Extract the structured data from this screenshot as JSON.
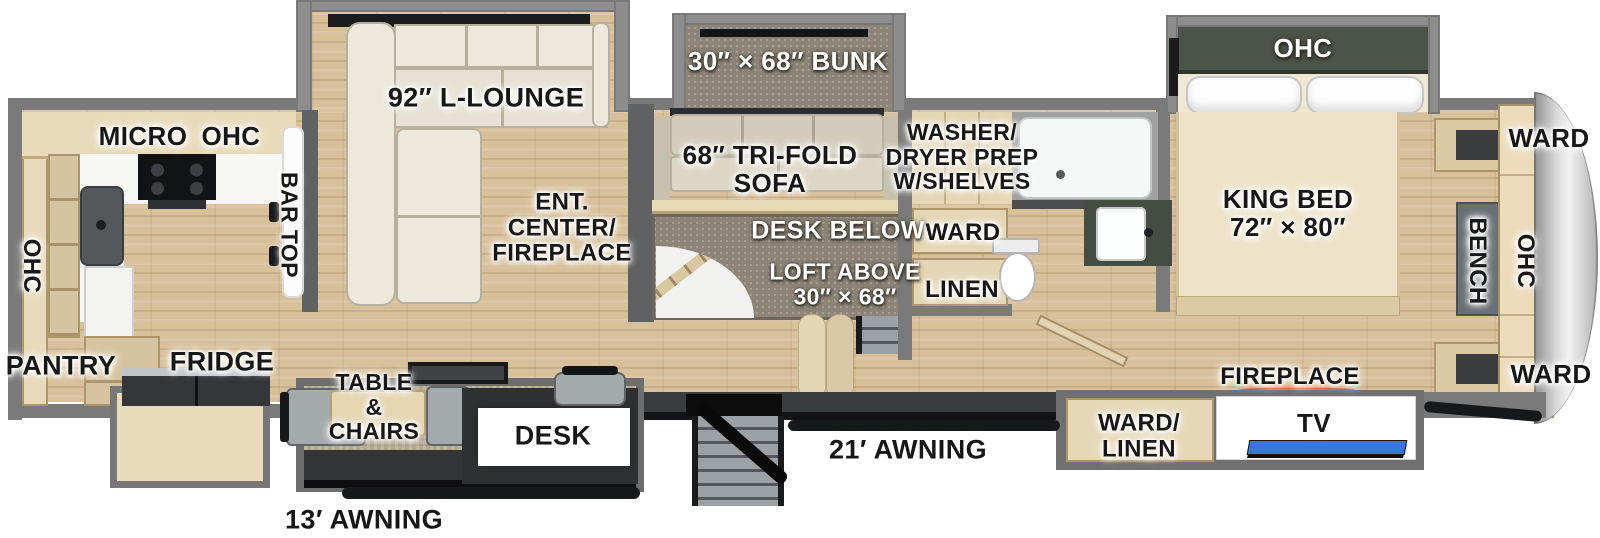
{
  "floorplan": {
    "type": "RV fifth-wheel floor plan",
    "colors": {
      "fireplace_glow": "#ff7a00",
      "tv_screen": "#3d74da",
      "awning_rod": "#17181a",
      "floor_wood": "#d8c09b",
      "wall_gray": "#7a7a7a"
    },
    "labels": {
      "micro": "MICRO",
      "ohc_kitchen_top": "OHC",
      "ohc_kitchen_left": "OHC",
      "pantry": "PANTRY",
      "fridge": "FRIDGE",
      "bar_top": "BAR TOP",
      "lounge": "92″ L-LOUNGE",
      "ent_center": "ENT.\nCENTER/\nFIREPLACE",
      "bunk": "30″ × 68″ BUNK",
      "trifold_sofa": "68″ TRI-FOLD\nSOFA",
      "washer_dryer": "WASHER/\nDRYER PREP\nW/SHELVES",
      "desk_below": "DESK BELOW",
      "loft_above": "LOFT ABOVE\n30″ × 68″",
      "ward_hall": "WARD",
      "linen_hall": "LINEN",
      "king_bed": "KING BED\n72″ × 80″",
      "ohc_bedroom": "OHC",
      "fireplace": "FIREPLACE",
      "ward_linen": "WARD/\nLINEN",
      "tv": "TV",
      "ward_front_top": "WARD",
      "ohc_front": "OHC",
      "bench": "BENCH",
      "ward_front_bottom": "WARD",
      "desk": "DESK",
      "table_chairs": "TABLE\n&\nCHAIRS",
      "awning_13": "13′ AWNING",
      "awning_21": "21′ AWNING"
    }
  }
}
